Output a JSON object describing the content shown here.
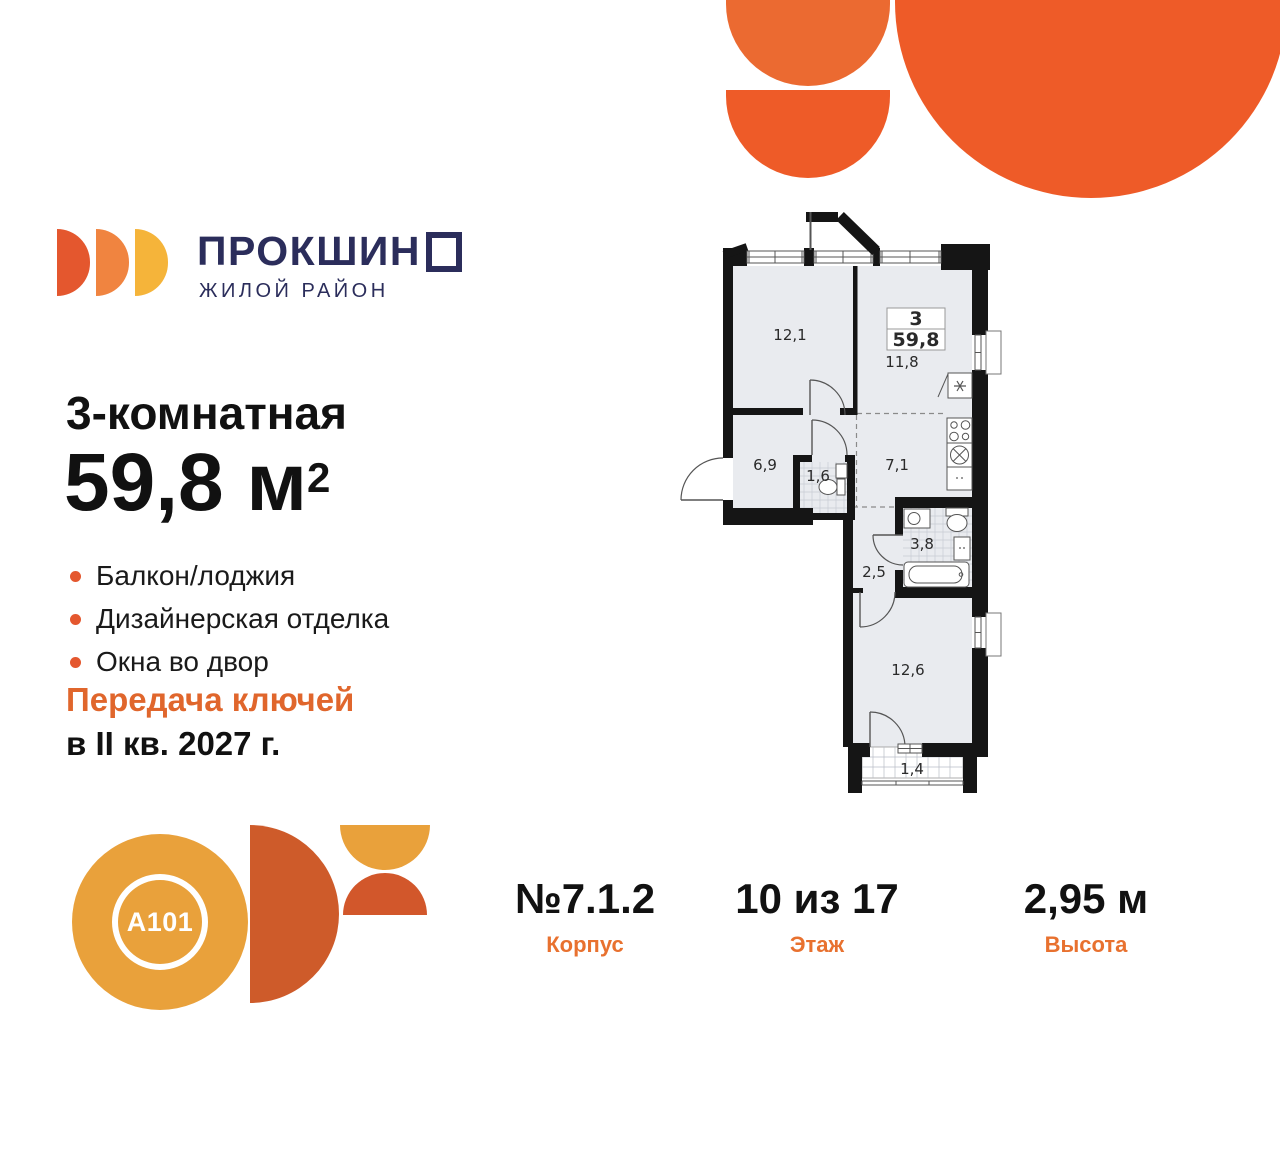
{
  "logo": {
    "brand_main": "ПРОКШИН",
    "brand_o": "О",
    "subtitle": "ЖИЛОЙ РАЙОН"
  },
  "listing": {
    "title": "3-комнатная",
    "area_value": "59,8 м",
    "area_sup": "2",
    "features": [
      "Балкон/лоджия",
      "Дизайнерская отделка",
      "Окна во двор"
    ],
    "keys_line1": "Передача ключей",
    "keys_line2": "в II кв. 2027 г."
  },
  "developer_badge": {
    "label": "A101"
  },
  "plan": {
    "unit": {
      "rooms_count": "3",
      "total_area": "59,8"
    },
    "rooms": [
      {
        "name": "living-room",
        "area": "12,1"
      },
      {
        "name": "kitchen-living",
        "area": "11,8"
      },
      {
        "name": "hallway",
        "area": "6,9"
      },
      {
        "name": "wc",
        "area": "1,6"
      },
      {
        "name": "corridor",
        "area": "7,1"
      },
      {
        "name": "bathroom",
        "area": "3,8"
      },
      {
        "name": "hall",
        "area": "2,5"
      },
      {
        "name": "bedroom",
        "area": "12,6"
      },
      {
        "name": "balcony",
        "area": "1,4"
      }
    ]
  },
  "stats": [
    {
      "value": "№7.1.2",
      "label": "Корпус"
    },
    {
      "value": "10 из 17",
      "label": "Этаж"
    },
    {
      "value": "2,95 м",
      "label": "Высота"
    }
  ],
  "colors": {
    "accent_orange": "#E0662C",
    "navy": "#2B2D5B",
    "amber": "#E9A13B",
    "burnt_orange": "#CE5B2A",
    "bright_orange": "#EE5B28",
    "plan_floor": "#E9EBEF",
    "wall": "#151515"
  }
}
